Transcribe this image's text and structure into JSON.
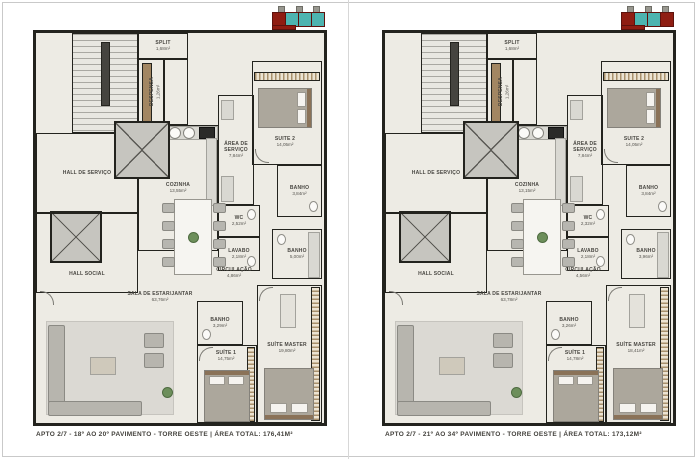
{
  "page": {
    "background": "#ffffff",
    "frame_color": "#c9c9c9",
    "keyplan_colors": {
      "highlight_red": "#8f1d12",
      "unit_teal": "#4db4b0"
    },
    "wall_color": "#23231e"
  },
  "plans": [
    {
      "caption": "APTO 2/7 - 18º AO 20º PAVIMENTO - TORRE OESTE  |  ÁREA TOTAL: 176,41M²",
      "rooms": {
        "split": {
          "name": "SPLIT",
          "area": "1,68m²"
        },
        "despensa": {
          "name": "DESPENSA",
          "area": "1,26m²"
        },
        "cozinha": {
          "name": "COZINHA",
          "area": "13,55m²"
        },
        "area_servico": {
          "name": "ÁREA DE SERVIÇO",
          "area": "7,84m²"
        },
        "suite2": {
          "name": "SUITE 2",
          "area": "14,05m²"
        },
        "banho_suite2": {
          "name": "BANHO",
          "area": "3,84m²"
        },
        "hall_servico": {
          "name": "HALL DE SERVIÇO"
        },
        "hall_social": {
          "name": "HALL SOCIAL"
        },
        "wc": {
          "name": "WC",
          "area": "2,52m²"
        },
        "lavabo": {
          "name": "LAVABO",
          "area": "2,18m²"
        },
        "banho_social": {
          "name": "BANHO",
          "area": "5,00m²"
        },
        "circulacao": {
          "name": "CIRCULAÇÃO",
          "area": "4,86m²"
        },
        "sala": {
          "name": "SALA DE ESTAR/JANTAR",
          "area": "63,76m²"
        },
        "banho_suite1": {
          "name": "BANHO",
          "area": "3,29m²"
        },
        "suite1": {
          "name": "SUÍTE 1",
          "area": "14,75m²"
        },
        "suite_master": {
          "name": "SUÍTE MASTER",
          "area": "19,80m²"
        }
      }
    },
    {
      "caption": "APTO 2/7 - 21º AO 34º PAVIMENTO - TORRE OESTE  |  ÁREA TOTAL: 173,12M²",
      "rooms": {
        "split": {
          "name": "SPLIT",
          "area": "1,68m²"
        },
        "despensa": {
          "name": "DESPENSA",
          "area": "1,26m²"
        },
        "cozinha": {
          "name": "COZINHA",
          "area": "13,15m²"
        },
        "area_servico": {
          "name": "ÁREA DE SERVIÇO",
          "area": "7,84m²"
        },
        "suite2": {
          "name": "SUITE 2",
          "area": "14,05m²"
        },
        "banho_suite2": {
          "name": "BANHO",
          "area": "3,84m²"
        },
        "hall_servico": {
          "name": "HALL DE SERVIÇO"
        },
        "hall_social": {
          "name": "HALL SOCIAL"
        },
        "wc": {
          "name": "WC",
          "area": "2,32m²"
        },
        "lavabo": {
          "name": "LAVABO",
          "area": "2,18m²"
        },
        "banho_social": {
          "name": "BANHO",
          "area": "3,96m²"
        },
        "circulacao": {
          "name": "CIRCULAÇÃO",
          "area": "4,56m²"
        },
        "sala": {
          "name": "SALA DE ESTAR/JANTAR",
          "area": "63,78m²"
        },
        "banho_suite1": {
          "name": "BANHO",
          "area": "3,26m²"
        },
        "suite1": {
          "name": "SUÍTE 1",
          "area": "14,78m²"
        },
        "suite_master": {
          "name": "SUÍTE MASTER",
          "area": "18,41m²"
        }
      }
    }
  ]
}
